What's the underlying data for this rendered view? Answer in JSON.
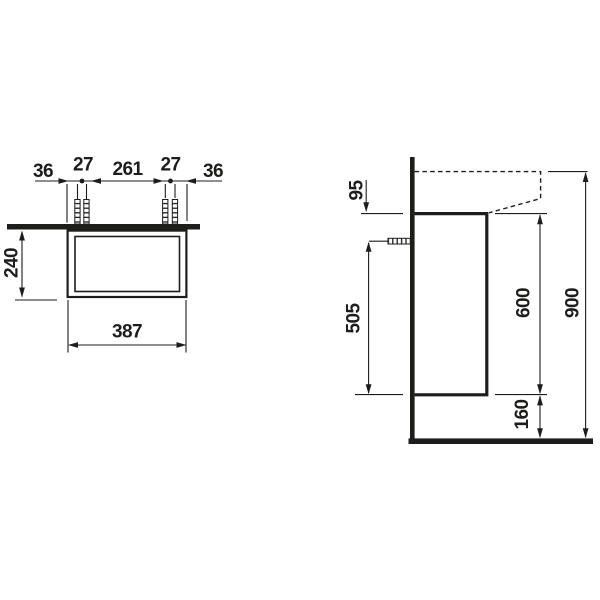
{
  "title": "Vanity unit installation drawing",
  "colors": {
    "ink": "#1d1d1b",
    "background": "#ffffff"
  },
  "front_view": {
    "top_chain": [
      "36",
      "27",
      "261",
      "27",
      "36"
    ],
    "height_label": "240",
    "width_label": "387"
  },
  "side_view": {
    "rim_to_carcass_label": "95",
    "fixing_height_label": "505",
    "carcass_height_label": "600",
    "floor_clearance_label": "160",
    "rim_height_label": "900"
  }
}
